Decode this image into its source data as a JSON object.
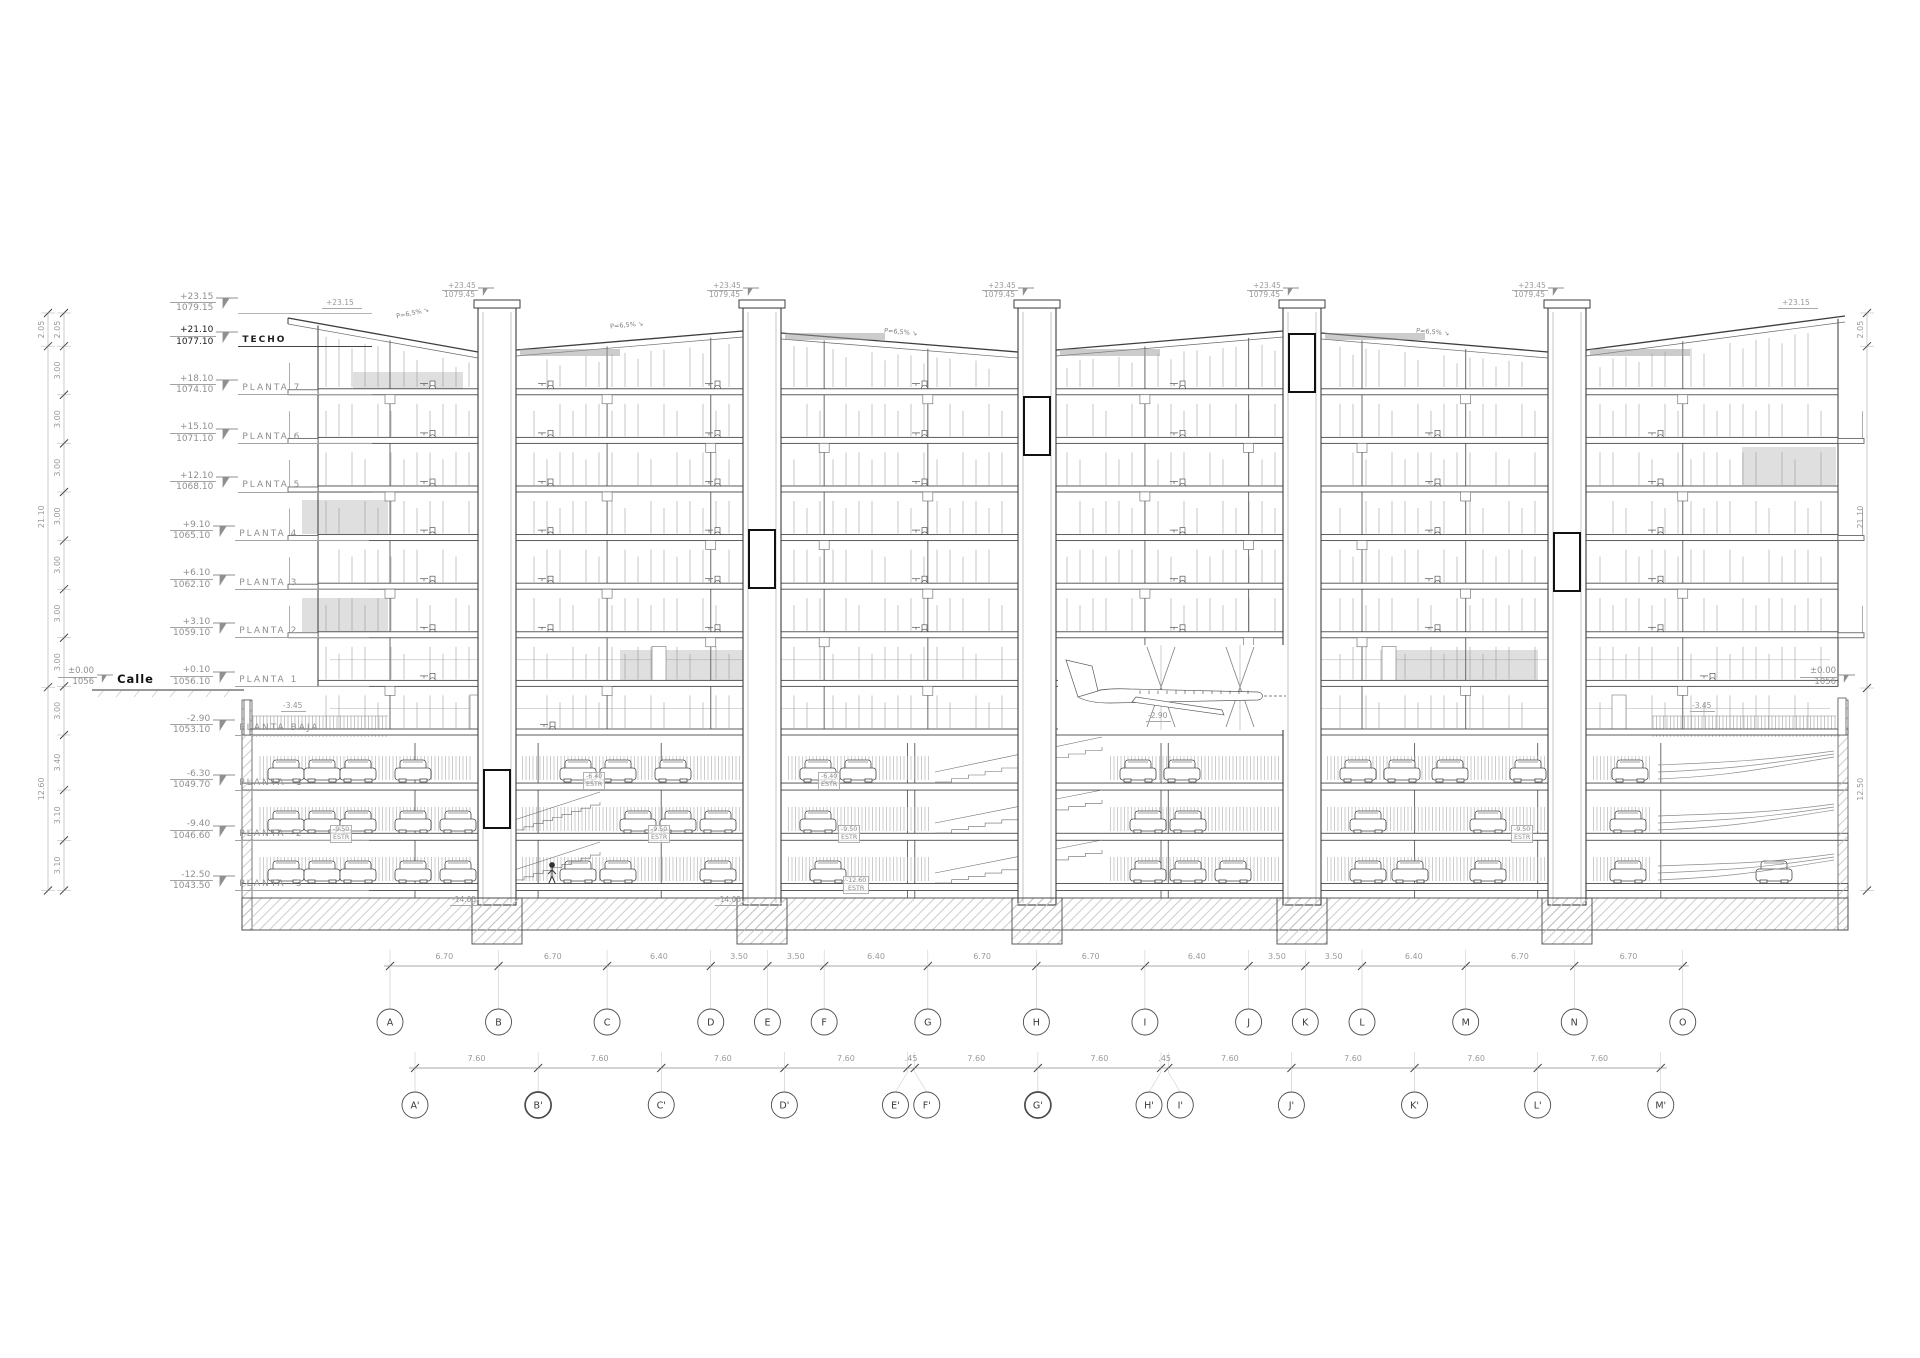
{
  "meta": {
    "drawing_type": "building longitudinal section",
    "language": "es"
  },
  "colors": {
    "paper": "#ffffff",
    "ink": "#222222",
    "line": "#5f5f5f",
    "faint": "#9c9c9c",
    "text_grey": "#8f8f8f",
    "glazing": "#d9d9d9"
  },
  "levels": [
    {
      "elev_label": "+23.15",
      "altitude_label": "1079.15",
      "name": "",
      "elevation_m": 23.15,
      "bold": false
    },
    {
      "elev_label": "+21.10",
      "altitude_label": "1077.10",
      "name": "TECHO",
      "elevation_m": 21.1,
      "bold": true
    },
    {
      "elev_label": "+18.10",
      "altitude_label": "1074.10",
      "name": "PLANTA 7",
      "elevation_m": 18.1,
      "bold": false
    },
    {
      "elev_label": "+15.10",
      "altitude_label": "1071.10",
      "name": "PLANTA 6",
      "elevation_m": 15.1,
      "bold": false
    },
    {
      "elev_label": "+12.10",
      "altitude_label": "1068.10",
      "name": "PLANTA 5",
      "elevation_m": 12.1,
      "bold": false
    },
    {
      "elev_label": "+9.10",
      "altitude_label": "1065.10",
      "name": "PLANTA 4",
      "elevation_m": 9.1,
      "bold": false
    },
    {
      "elev_label": "+6.10",
      "altitude_label": "1062.10",
      "name": "PLANTA 3",
      "elevation_m": 6.1,
      "bold": false
    },
    {
      "elev_label": "+3.10",
      "altitude_label": "1059.10",
      "name": "PLANTA 2",
      "elevation_m": 3.1,
      "bold": false
    },
    {
      "elev_label": "+0.10",
      "altitude_label": "1056.10",
      "name": "PLANTA 1",
      "elevation_m": 0.1,
      "bold": false
    },
    {
      "elev_label": "-2.90",
      "altitude_label": "1053.10",
      "name": "PLANTA BAJA",
      "elevation_m": -2.9,
      "bold": false
    },
    {
      "elev_label": "-6.30",
      "altitude_label": "1049.70",
      "name": "PLANTA -1",
      "elevation_m": -6.3,
      "bold": false
    },
    {
      "elev_label": "-9.40",
      "altitude_label": "1046.60",
      "name": "PLANTA -2",
      "elevation_m": -9.4,
      "bold": false
    },
    {
      "elev_label": "-12.50",
      "altitude_label": "1043.50",
      "name": "PLANTA -3",
      "elevation_m": -12.5,
      "bold": false
    }
  ],
  "street_marks": [
    {
      "elev_label": "±0.00",
      "altitude_label": "1056",
      "name": "Calle",
      "side": "left"
    },
    {
      "elev_label": "±0.00",
      "altitude_label": "1056",
      "name": "",
      "side": "right"
    }
  ],
  "roof_marks": {
    "tower_mark": {
      "elev_label": "+23.45",
      "altitude_label": "1079.45"
    },
    "eave_marks": [
      {
        "elev_label": "+23.15",
        "side": "left"
      },
      {
        "elev_label": "+23.15",
        "side": "right"
      }
    ]
  },
  "slope_labels": [
    {
      "text": "P=6,5%",
      "x": 396,
      "y": 310,
      "rot": -12
    },
    {
      "text": "P=6,5%",
      "x": 610,
      "y": 322,
      "rot": -5
    },
    {
      "text": "P=6,5%",
      "x": 884,
      "y": 329,
      "rot": 5
    },
    {
      "text": "P=6,5%",
      "x": 1416,
      "y": 329,
      "rot": 5
    }
  ],
  "dim_chains": {
    "left_outer": {
      "labels": [
        "2.05",
        "21.10",
        "12.60"
      ],
      "bounds": [
        23.15,
        21.1,
        0.05,
        -12.5
      ]
    },
    "left_inner": {
      "labels": [
        "2.05",
        "3.00",
        "3.00",
        "3.00",
        "3.00",
        "3.00",
        "3.00",
        "3.00",
        "3.00",
        "3.40",
        "3.10",
        "3.10"
      ],
      "bounds": [
        23.15,
        21.1,
        18.1,
        15.1,
        12.1,
        9.1,
        6.1,
        3.1,
        0.1,
        -2.9,
        -6.3,
        -9.4,
        -12.5
      ]
    },
    "right": {
      "labels": [
        "2.05",
        "21.10",
        "12.50"
      ],
      "bounds": [
        23.15,
        21.1,
        0.0,
        -12.5
      ]
    }
  },
  "grid_rows": [
    {
      "letters": [
        "A",
        "B",
        "C",
        "D",
        "E",
        "F",
        "G",
        "H",
        "I",
        "J",
        "K",
        "L",
        "M",
        "N",
        "O"
      ],
      "spans": [
        "6.70",
        "6.70",
        "6.40",
        "3.50",
        "3.50",
        "6.40",
        "6.70",
        "6.70",
        "6.40",
        "3.50",
        "3.50",
        "6.40",
        "6.70",
        "6.70"
      ],
      "bold_letters": []
    },
    {
      "letters": [
        "A'",
        "B'",
        "C'",
        "D'",
        "E'",
        "F'",
        "G'",
        "H'",
        "I'",
        "J'",
        "K'",
        "L'",
        "M'"
      ],
      "spans": [
        "7.60",
        "7.60",
        "7.60",
        "7.60",
        ".45",
        "7.60",
        "7.60",
        ".45",
        "7.60",
        "7.60",
        "7.60",
        "7.60"
      ],
      "bold_letters": [
        "B'",
        "G'"
      ]
    }
  ],
  "annotations": [
    {
      "text": "-3.45",
      "x": 281,
      "y": 702,
      "u": true
    },
    {
      "text": "-3.45",
      "x": 1690,
      "y": 702,
      "u": true
    },
    {
      "text": "-2.90",
      "x": 1146,
      "y": 712,
      "u": true
    },
    {
      "text": "-14.05",
      "x": 450,
      "y": 896,
      "u": true
    },
    {
      "text": "-14.05",
      "x": 715,
      "y": 896,
      "u": true
    }
  ],
  "estr_labels": [
    {
      "line1": "-6.40",
      "line2": "ESTR",
      "x": 583,
      "y": 772
    },
    {
      "line1": "-6.40",
      "line2": "ESTR",
      "x": 818,
      "y": 772
    },
    {
      "line1": "-9.50",
      "line2": "ESTR",
      "x": 330,
      "y": 825
    },
    {
      "line1": "-9.50",
      "line2": "ESTR",
      "x": 648,
      "y": 825
    },
    {
      "line1": "-9.50",
      "line2": "ESTR",
      "x": 838,
      "y": 825
    },
    {
      "line1": "-9.50",
      "line2": "ESTR",
      "x": 1511,
      "y": 825
    },
    {
      "line1": "-12.60",
      "line2": "ESTR",
      "x": 843,
      "y": 876
    }
  ]
}
